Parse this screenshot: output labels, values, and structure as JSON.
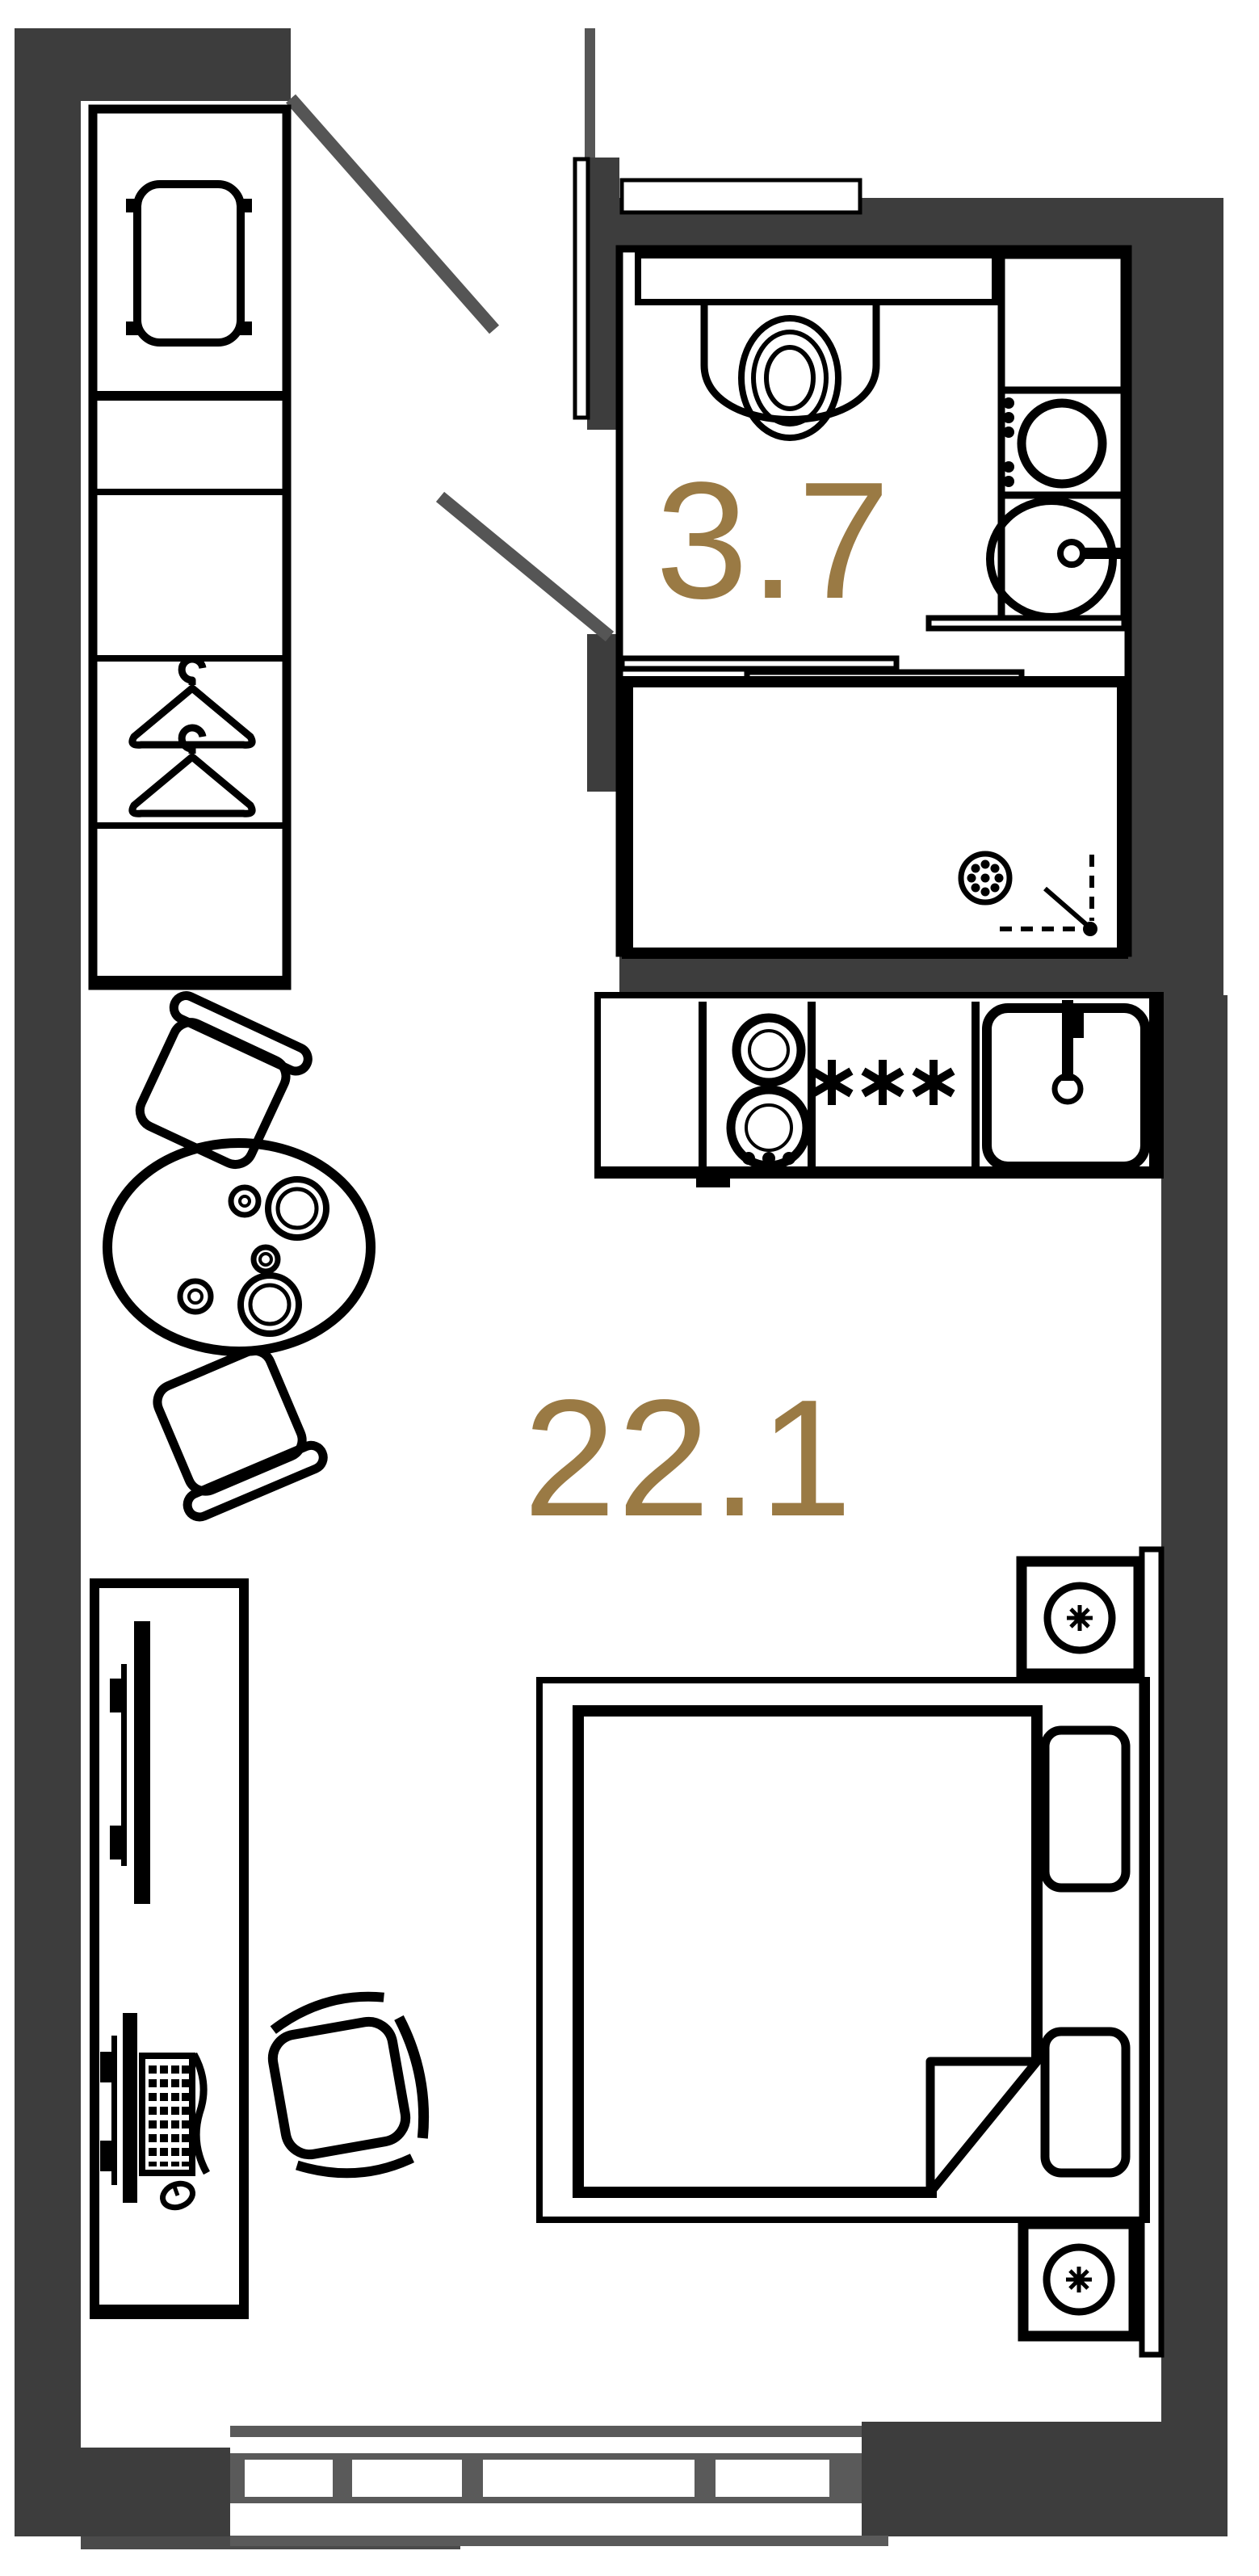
{
  "plan": {
    "kind": "apartment-floor-plan",
    "background": "#ffffff"
  },
  "colors": {
    "wall_fill": "#3d3d3d",
    "line_black": "#000000",
    "door_gray": "#555555",
    "window_gray": "#5a5a5a",
    "area_text": "#9a7a44"
  },
  "rooms": [
    {
      "id": "bathroom",
      "area_label": "3.7"
    },
    {
      "id": "living-room",
      "area_label": "22.1"
    }
  ],
  "furniture_icons": [
    "wardrobe-with-shelves",
    "storage-tray",
    "clothes-hanger",
    "clothes-hanger",
    "round-dining-table",
    "plate",
    "plate",
    "cup",
    "cup",
    "bowl",
    "dining-chair",
    "dining-chair",
    "entry-door-swing",
    "bathroom-door-swing",
    "vanity-counter",
    "wall-hung-toilet",
    "bathroom-cabinet",
    "washing-machine",
    "bathroom-sink",
    "shower-tray",
    "floor-drain",
    "shower-head-marker",
    "sliding-glass-partition",
    "kitchen-counter",
    "two-burner-hob",
    "kitchen-asterisk-marks",
    "kitchen-sink",
    "kitchen-faucet",
    "desk",
    "wall-tv",
    "monitor",
    "keyboard",
    "mouse",
    "office-chair",
    "double-bed",
    "blanket-fold",
    "pillow",
    "pillow",
    "nightstand-with-lamp",
    "nightstand-with-lamp",
    "radiator-panel",
    "window-bottom"
  ]
}
